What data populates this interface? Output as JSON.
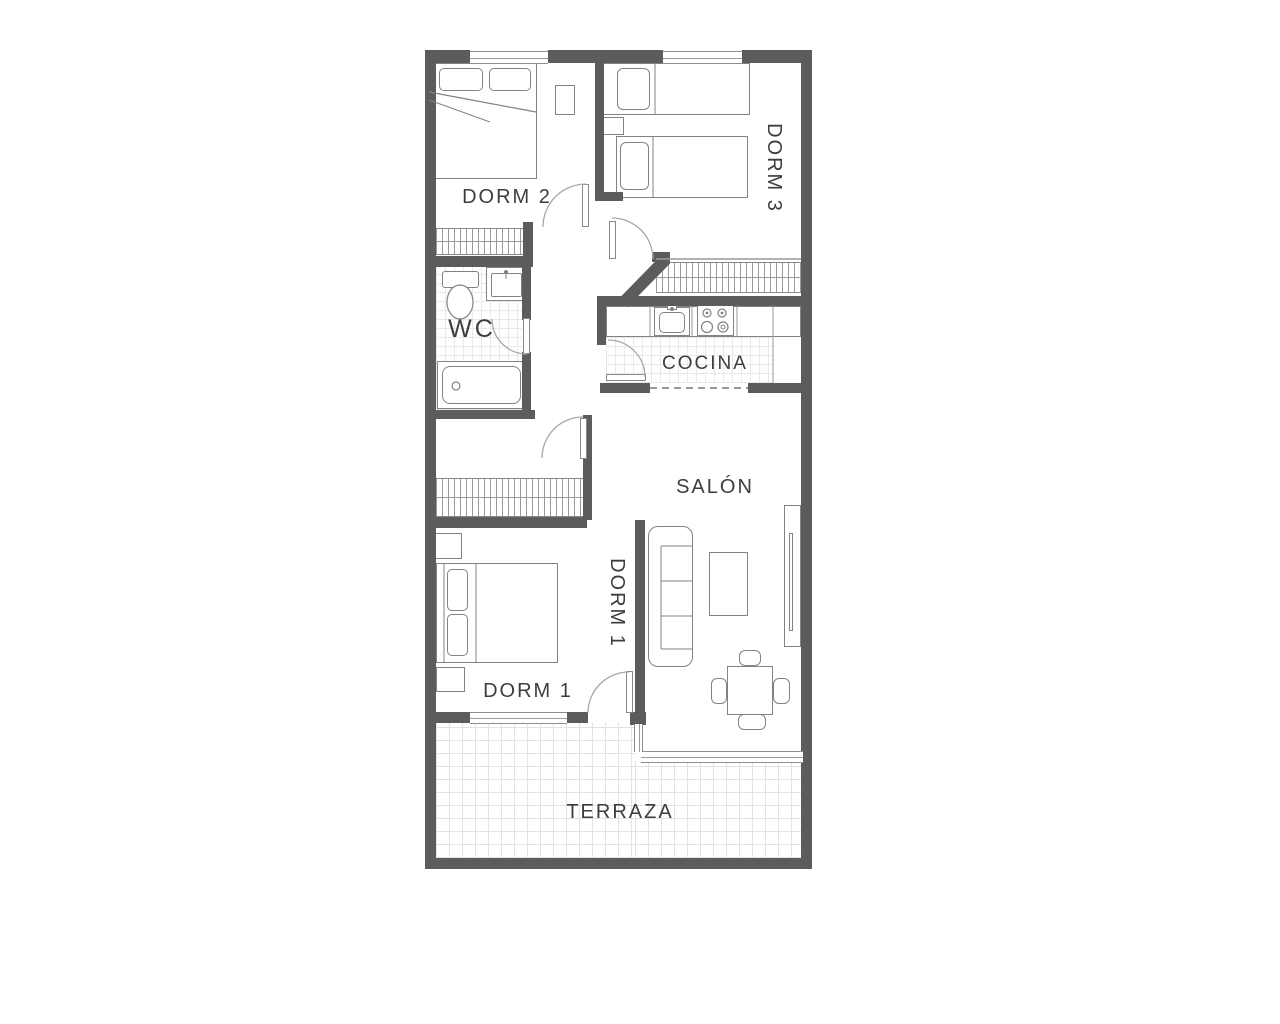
{
  "floor_plan": {
    "labels": {
      "dorm2": "DORM 2",
      "dorm3": "DORM 3",
      "wc": "WC",
      "cocina": "COCINA",
      "salon": "SALÓN",
      "dorm1_vertical": "DORM 1",
      "dorm1": "DORM 1",
      "terraza": "TERRAZA"
    },
    "colors": {
      "background": "#ffffff",
      "wall": "#5c5c5c",
      "furniture_line": "#838383",
      "door_arc": "#a8a8a8",
      "tile_line": "#e2e2e2",
      "hatch_line": "#9a9a9a",
      "label_text": "#3d3d3d"
    }
  }
}
